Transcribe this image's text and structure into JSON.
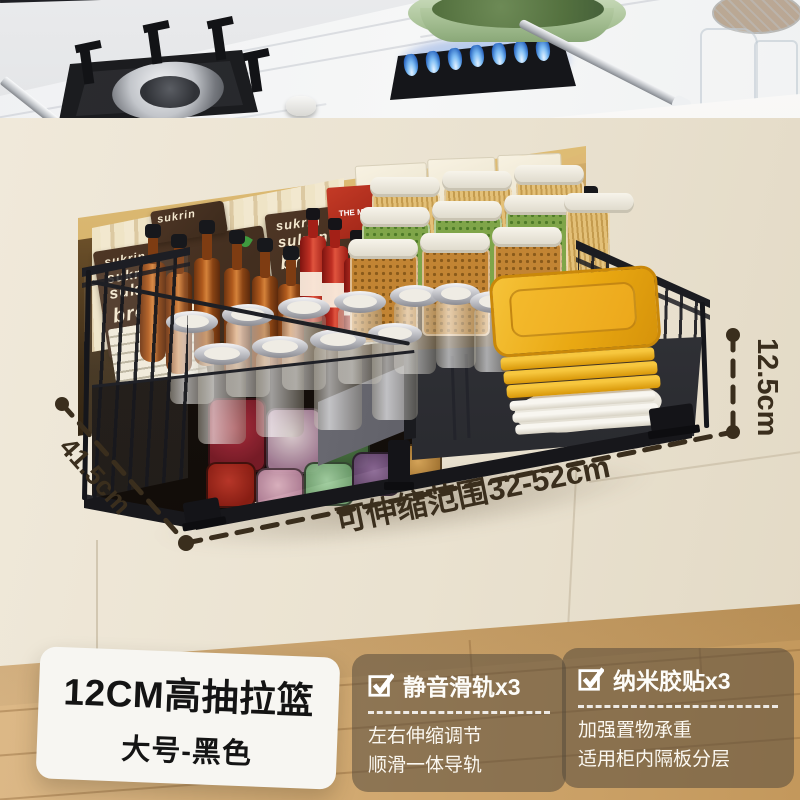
{
  "annotations": {
    "height_label": "12.5cm",
    "depth_label": "41.5cm",
    "range_label": "可伸缩范围32-52cm"
  },
  "badge": {
    "title": "12CM高抽拉篮",
    "subtitle": "大号-黑色"
  },
  "features": [
    {
      "title": "静音滑轨x3",
      "desc1": "左右伸缩调节",
      "desc2": "顺滑一体导轨"
    },
    {
      "title": "纳米胶贴x3",
      "desc1": "加强置物承重",
      "desc2": "适用柜内隔板分层"
    }
  ],
  "packaging": {
    "brand": "sukrin",
    "product": "bread mix",
    "box": "THE MIX"
  },
  "colors": {
    "dimension_ink": "#3a2e1d",
    "badge_text": "#141414",
    "panel_text": "#fdfcf8",
    "basket_black": "#1d1e23",
    "plate_yellow": "#e9a812",
    "wood_floor": "#d0a76e",
    "marble": "#f2f3f4",
    "cabinet_beige": "#ece4d2"
  }
}
